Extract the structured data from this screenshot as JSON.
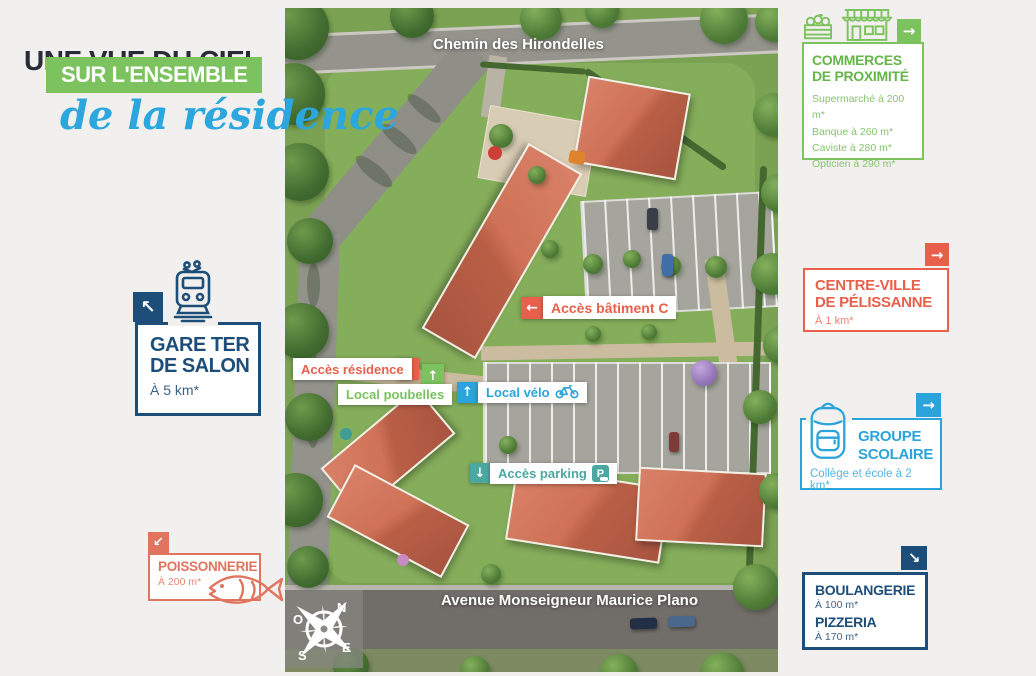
{
  "intro": {
    "title": "UNE VUE DU CIEL",
    "subtitle": "SUR L'ENSEMBLE",
    "tagline": "de la résidence"
  },
  "colors": {
    "background": "#f1f0ee",
    "navy": "#1d4e79",
    "green": "#7cc25e",
    "orange": "#e8604b",
    "salmon": "#e0745e",
    "blue": "#2aa4da",
    "teal": "#4ba8a0",
    "script_blue": "#2ba7dd"
  },
  "landmarks": {
    "gare": {
      "arrow": "↖",
      "title1": "GARE TER",
      "title2": "DE SALON",
      "distance": "À 5 km*"
    },
    "poissonnerie": {
      "arrow": "↙",
      "title": "POISSONNERIE",
      "distance": "À 200 m*"
    },
    "commerces": {
      "arrow": "→",
      "title1": "COMMERCES",
      "title2": "DE PROXIMITÉ",
      "items": [
        "Supermarché à 200 m*",
        "Banque à 260 m*",
        "Caviste à 280 m*",
        "Opticien à 290 m*"
      ]
    },
    "centre_ville": {
      "arrow": "→",
      "title1": "CENTRE-VILLE",
      "title2": "DE PÉLISSANNE",
      "distance": "À 1 km*"
    },
    "groupe_scolaire": {
      "arrow": "→",
      "title1": "GROUPE",
      "title2": "SCOLAIRE",
      "distance": "Collège et école à 2 km*"
    },
    "boulangerie_pizzeria": {
      "arrow": "↘",
      "title1": "BOULANGERIE",
      "distance1": "À 100 m*",
      "title2": "PIZZERIA",
      "distance2": "À 170 m*"
    }
  },
  "map": {
    "streets": {
      "top": "Chemin des Hirondelles",
      "bottom": "Avenue Monseigneur Maurice Plano"
    },
    "labels": {
      "batiment_c": {
        "arrow": "←",
        "text": "Accès bâtiment C"
      },
      "residence": {
        "arrow": "↘",
        "text": "Accès résidence"
      },
      "poubelles": {
        "arrow": "↑",
        "text": "Local poubelles"
      },
      "velo": {
        "arrow": "↑",
        "text": "Local vélo"
      },
      "parking": {
        "arrow": "↓",
        "text": "Accès parking",
        "icon_letter": "P"
      }
    },
    "compass": {
      "n": "N",
      "e": "E",
      "s": "S",
      "o": "O"
    }
  }
}
